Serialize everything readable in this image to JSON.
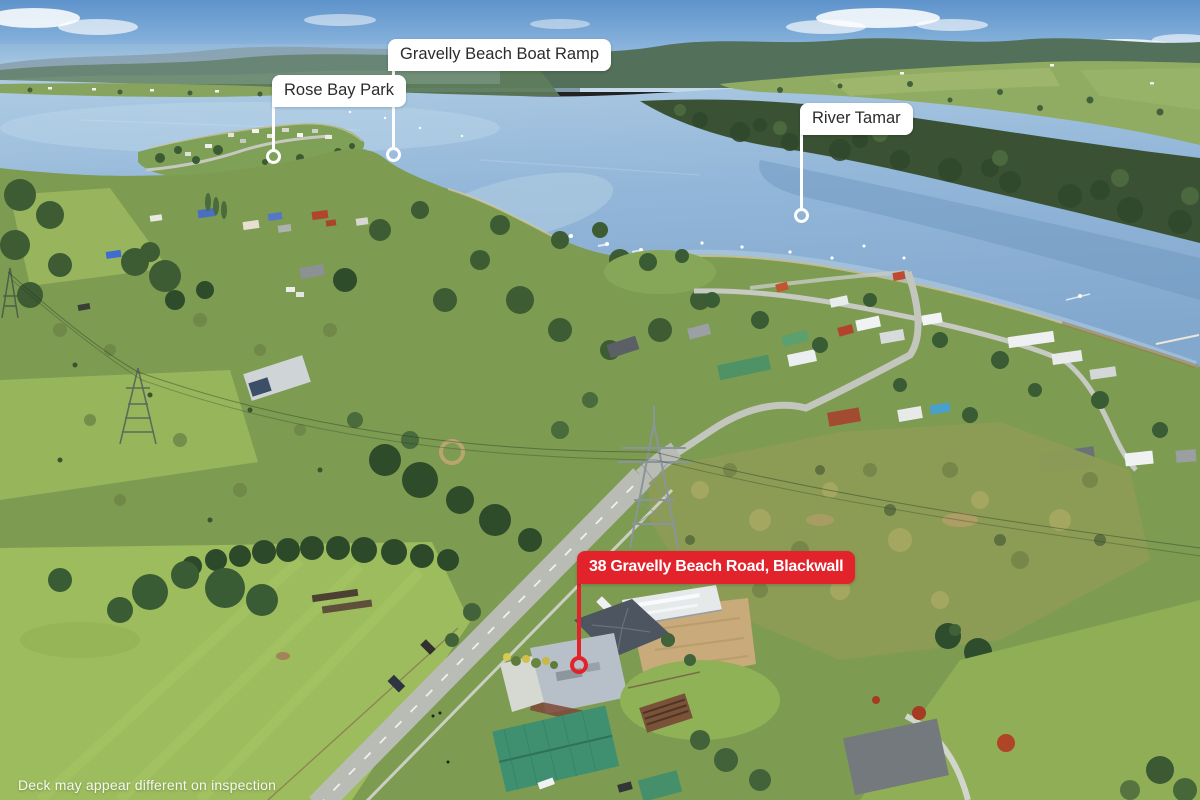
{
  "callouts": {
    "rose_bay_park": {
      "label": "Rose Bay Park"
    },
    "boat_ramp": {
      "label": "Gravelly Beach Boat Ramp"
    },
    "river_tamar": {
      "label": "River Tamar"
    },
    "property": {
      "label": "38 Gravelly Beach Road, Blackwall"
    }
  },
  "watermark": {
    "disclaimer": "Deck may appear different on inspection"
  },
  "colors": {
    "accent_red": "#e2232c",
    "callout_bg": "#ffffff",
    "callout_text": "#2c2c2c",
    "property_text": "#ffffff"
  }
}
